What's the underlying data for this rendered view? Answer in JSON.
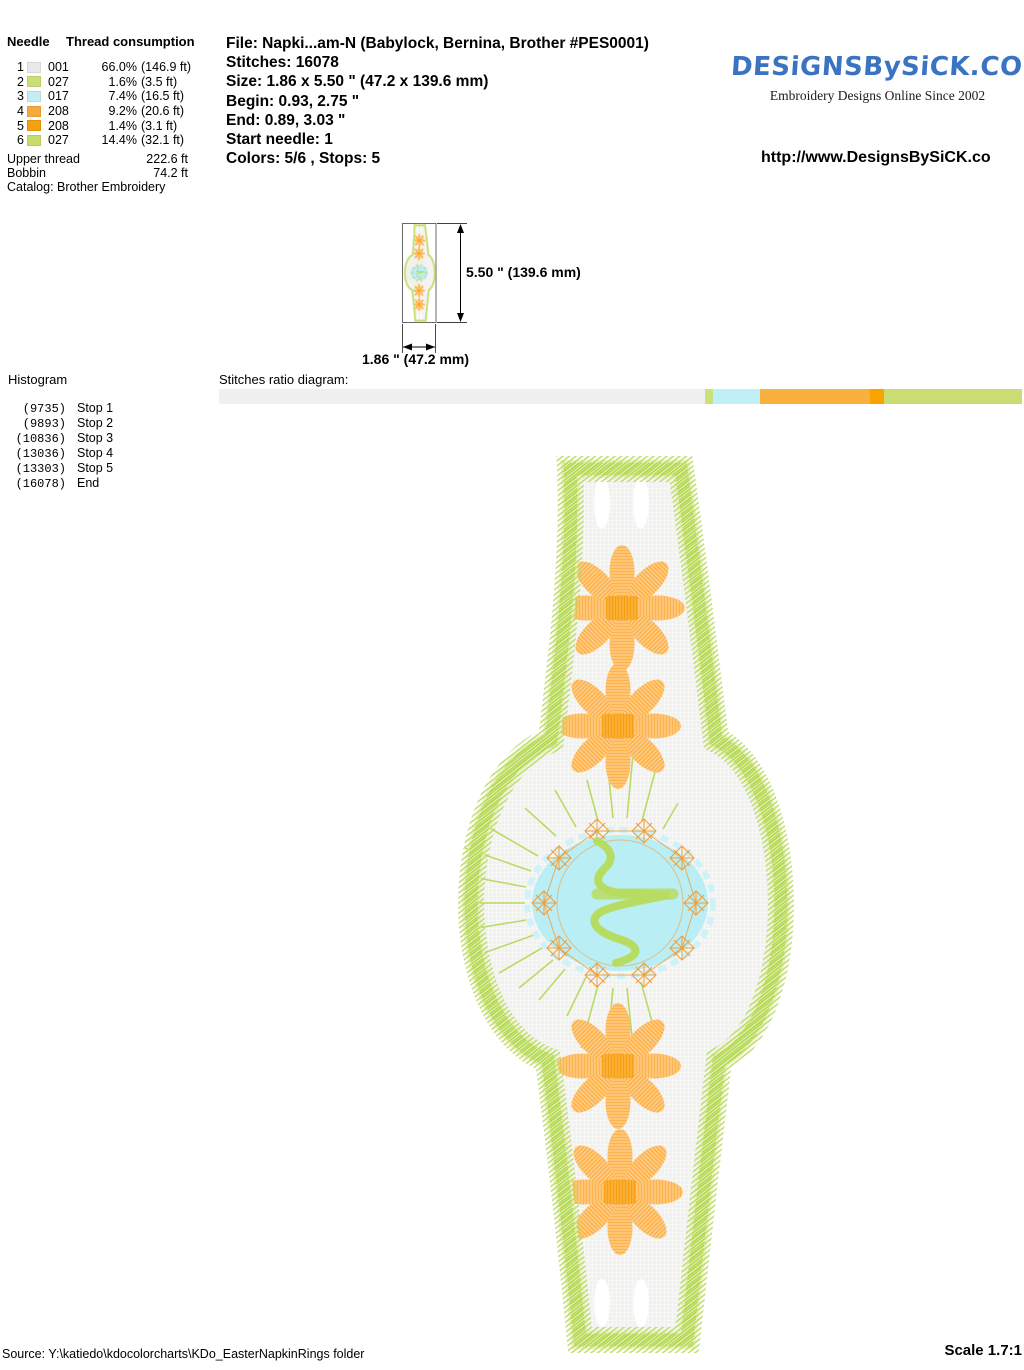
{
  "header": {
    "needle_table": {
      "col_needle": "Needle",
      "col_thread": "Thread consumption",
      "rows": [
        {
          "needle": "1",
          "code": "001",
          "color": "#e9e9e9",
          "pct": "66.0%",
          "length": "(146.9 ft)"
        },
        {
          "needle": "2",
          "code": "027",
          "color": "#cbdf79",
          "pct": "1.6%",
          "length": "(3.5 ft)"
        },
        {
          "needle": "3",
          "code": "017",
          "color": "#c5eef2",
          "pct": "7.4%",
          "length": "(16.5 ft)"
        },
        {
          "needle": "4",
          "code": "208",
          "color": "#f6aa3d",
          "pct": "9.2%",
          "length": "(20.6 ft)"
        },
        {
          "needle": "5",
          "code": "208",
          "color": "#f5a00f",
          "pct": "1.4%",
          "length": "(3.1 ft)"
        },
        {
          "needle": "6",
          "code": "027",
          "color": "#c9dc6a",
          "pct": "14.4%",
          "length": "(32.1 ft)"
        }
      ],
      "upper_thread_label": "Upper thread",
      "upper_thread_value": "222.6 ft",
      "bobbin_label": "Bobbin",
      "bobbin_value": "74.2 ft",
      "catalog": "Catalog: Brother Embroidery"
    },
    "file_info": {
      "file": "File: Napki...am-N  (Babylock, Bernina, Brother #PES0001)",
      "stitches": "Stitches: 16078",
      "size": "Size: 1.86 x 5.50 \" (47.2 x 139.6 mm)",
      "begin": "Begin: 0.93, 2.75 \"",
      "end": "End: 0.89, 3.03 \"",
      "start_needle": "Start needle: 1",
      "colors": "Colors: 5/6 , Stops: 5"
    },
    "brand": {
      "logo": "DESiGNSBySiCK.COM",
      "tagline": "Embroidery Designs Online Since 2002",
      "url": "http://www.DesignsBySiCK.co"
    }
  },
  "dimensions": {
    "height_label": "5.50 \" (139.6 mm)",
    "width_label": "1.86 \" (47.2 mm)"
  },
  "histogram": {
    "title": "Histogram",
    "entries": [
      {
        "count": "(9735)",
        "label": "Stop 1"
      },
      {
        "count": "(9893)",
        "label": "Stop 2"
      },
      {
        "count": "(10836)",
        "label": "Stop 3"
      },
      {
        "count": "(13036)",
        "label": "Stop 4"
      },
      {
        "count": "(13303)",
        "label": "Stop 5"
      },
      {
        "count": "(16078)",
        "label": "End"
      }
    ]
  },
  "ratio_diagram": {
    "label": "Stitches ratio diagram:",
    "segments": [
      {
        "pct": 60.5,
        "color": "#f0f0ef"
      },
      {
        "pct": 1.0,
        "color": "#cbe27b"
      },
      {
        "pct": 5.9,
        "color": "#bff0f6"
      },
      {
        "pct": 13.7,
        "color": "#f8b13f"
      },
      {
        "pct": 1.7,
        "color": "#f8a300"
      },
      {
        "pct": 17.2,
        "color": "#cadd72"
      }
    ]
  },
  "design_colors": {
    "fringe_green": "#bcda5e",
    "fill_gray": "#f1f1ef",
    "daisy_orange": "#fdb44f",
    "daisy_center_orange": "#f8a011",
    "medallion_cyan": "#baeef5",
    "wreath_orange": "#ee9e3a",
    "squiggle_green": "#b7dc62"
  },
  "footer": {
    "source": "Source: Y:\\katiedo\\kdocolorcharts\\KDo_EasterNapkinRings folder",
    "scale": "Scale 1.7:1"
  }
}
